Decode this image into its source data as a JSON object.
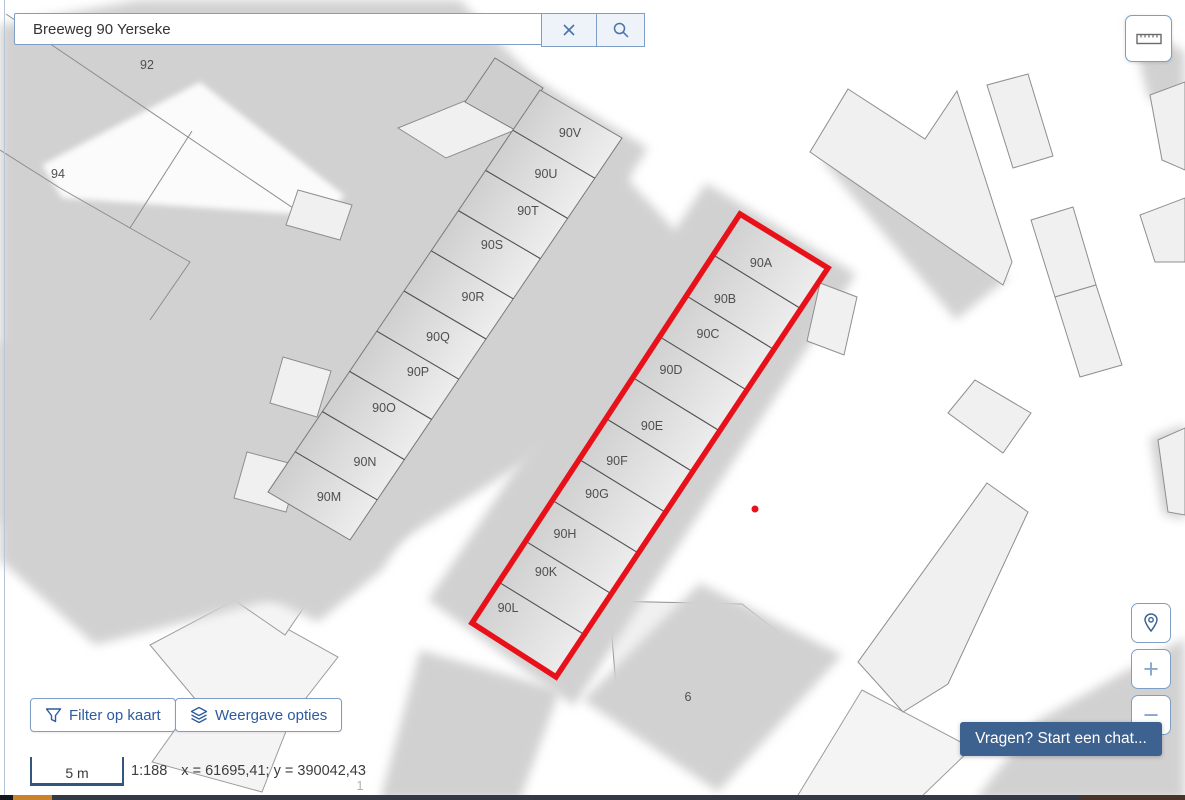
{
  "colors": {
    "selection_red": "#e8111a",
    "ui_border_blue": "#7d9fc6",
    "ui_text_blue": "#2d5b9e",
    "chat_background": "#3d6290"
  },
  "search": {
    "value": "Breeweg 90 Yerseke",
    "clear_icon": "x-icon",
    "search_icon": "magnifier-icon"
  },
  "topbar": {
    "measure_icon": "ruler-icon"
  },
  "footer_buttons": {
    "filter": {
      "label": "Filter op kaart",
      "icon": "funnel-icon"
    },
    "display": {
      "label": "Weergave opties",
      "icon": "layers-icon"
    }
  },
  "map_controls": {
    "locate_icon": "map-pin-icon",
    "zoom_in_label": "+",
    "zoom_out_label": "−"
  },
  "chat": {
    "label": "Vragen? Start een chat..."
  },
  "status_bar": {
    "scale_label": "5 m",
    "scale_ratio": "1:188",
    "coordinates": "x = 61695,41; y = 390042,43"
  },
  "map": {
    "selected_address_units": [
      "90A",
      "90B",
      "90C",
      "90D",
      "90E",
      "90F",
      "90G",
      "90H",
      "90K",
      "90L"
    ],
    "labels": [
      {
        "text": "92",
        "x": 147,
        "y": 69
      },
      {
        "text": "94",
        "x": 58,
        "y": 178
      },
      {
        "text": "90V",
        "x": 570,
        "y": 137
      },
      {
        "text": "90U",
        "x": 546,
        "y": 178
      },
      {
        "text": "90T",
        "x": 528,
        "y": 215
      },
      {
        "text": "90S",
        "x": 492,
        "y": 249
      },
      {
        "text": "90R",
        "x": 473,
        "y": 301
      },
      {
        "text": "90Q",
        "x": 438,
        "y": 341
      },
      {
        "text": "90P",
        "x": 418,
        "y": 376
      },
      {
        "text": "90O",
        "x": 384,
        "y": 412
      },
      {
        "text": "90N",
        "x": 365,
        "y": 466
      },
      {
        "text": "90M",
        "x": 329,
        "y": 501
      },
      {
        "text": "90A",
        "x": 761,
        "y": 267
      },
      {
        "text": "90B",
        "x": 725,
        "y": 303
      },
      {
        "text": "90C",
        "x": 708,
        "y": 338
      },
      {
        "text": "90D",
        "x": 671,
        "y": 374
      },
      {
        "text": "90E",
        "x": 652,
        "y": 430
      },
      {
        "text": "90F",
        "x": 617,
        "y": 465
      },
      {
        "text": "90G",
        "x": 597,
        "y": 498
      },
      {
        "text": "90H",
        "x": 565,
        "y": 538
      },
      {
        "text": "90K",
        "x": 546,
        "y": 576
      },
      {
        "text": "90L",
        "x": 508,
        "y": 612
      },
      {
        "text": "6",
        "x": 688,
        "y": 701
      },
      {
        "text": "1",
        "x": 360,
        "y": 790,
        "muted": true
      }
    ]
  }
}
